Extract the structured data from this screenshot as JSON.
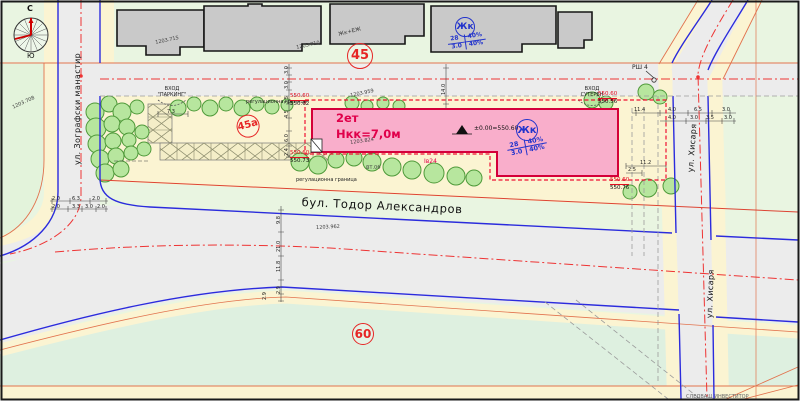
{
  "compass": {
    "north": "С",
    "south": "Ю"
  },
  "streets": {
    "left": "ул. Зографски манастир",
    "boulevard": "бул. Тодор Александров",
    "right": "ул. Хисаря"
  },
  "building": {
    "floors": "2ет",
    "height": "Нкк=7,0м",
    "datum": "±0.00=550.60",
    "plot_code": "Iв24"
  },
  "zone_symbols": [
    {
      "code": "Жк",
      "tl": "28",
      "tr": "40%",
      "bl": "3.0",
      "br": "40%"
    },
    {
      "code": "Жк",
      "tl": "28",
      "tr": "40%",
      "bl": "3.0",
      "br": "40%"
    }
  ],
  "annotations": {
    "entrance_parking_line1": "ВХОД",
    "entrance_parking_line2": "\"ПАРКИНГ\"",
    "entrance_basement_line1": "ВХОД",
    "entrance_basement_line2": "СУТЕРЕН",
    "reg_boundary": "регулационна граница",
    "manhole": "РШ 4",
    "building_top": "Жк+ЕЖ",
    "utility": "ВТ.06",
    "footer": "СЛЕДВАЩ ИНВЕСТИТОР"
  },
  "plot_circles": [
    {
      "label": "45",
      "x": 347,
      "y": 43,
      "d": 26,
      "fs": 13,
      "r": 0
    },
    {
      "label": "45а",
      "x": 234,
      "y": 118,
      "d": 23,
      "fs": 10,
      "r": -15
    },
    {
      "label": "60",
      "x": 352,
      "y": 323,
      "d": 22,
      "fs": 12,
      "r": 0
    }
  ],
  "elevations": [
    {
      "top": "550.60",
      "bottom": "550.62",
      "x": 290,
      "y": 93
    },
    {
      "top": "550.60",
      "bottom": "550.73",
      "x": 290,
      "y": 150
    },
    {
      "top": "550.60",
      "bottom": "550.76",
      "x": 610,
      "y": 177
    },
    {
      "top": "550.60",
      "bottom": "550.56",
      "x": 598,
      "y": 91
    }
  ],
  "survey_points": [
    {
      "t": "1203.708",
      "x": 12,
      "y": 106,
      "r": -25
    },
    {
      "t": "1203.715",
      "x": 155,
      "y": 41,
      "r": -12
    },
    {
      "t": "1203.710",
      "x": 296,
      "y": 46,
      "r": -12
    },
    {
      "t": "1203.959",
      "x": 350,
      "y": 94,
      "r": -12
    },
    {
      "t": "1203.824",
      "x": 350,
      "y": 141,
      "r": -8
    },
    {
      "t": "1203.962",
      "x": 316,
      "y": 226,
      "r": -3
    }
  ],
  "dimensions": [
    {
      "t": "3.0",
      "x": 285,
      "y": 74,
      "r": -90
    },
    {
      "t": "3.0",
      "x": 285,
      "y": 89,
      "r": -90
    },
    {
      "t": "3.5",
      "x": 285,
      "y": 104,
      "r": -90
    },
    {
      "t": "4.5",
      "x": 285,
      "y": 118,
      "r": -90
    },
    {
      "t": "6.0",
      "x": 285,
      "y": 142,
      "r": -90
    },
    {
      "t": "2.4",
      "x": 285,
      "y": 156,
      "r": -90
    },
    {
      "t": "9.8",
      "x": 277,
      "y": 224,
      "r": -90
    },
    {
      "t": "21.0",
      "x": 277,
      "y": 252,
      "r": -90
    },
    {
      "t": "11.8",
      "x": 277,
      "y": 272,
      "r": -90
    },
    {
      "t": "2.9",
      "x": 277,
      "y": 294,
      "r": -90
    },
    {
      "t": "2.9",
      "x": 263,
      "y": 300,
      "r": -90
    },
    {
      "t": "14.0",
      "x": 442,
      "y": 95,
      "r": -90
    },
    {
      "t": "7.3",
      "x": 167,
      "y": 110,
      "r": 0
    },
    {
      "t": "11.4",
      "x": 634,
      "y": 108,
      "r": 0
    },
    {
      "t": "4.0",
      "x": 668,
      "y": 108,
      "r": 0
    },
    {
      "t": "6.5",
      "x": 694,
      "y": 108,
      "r": 0
    },
    {
      "t": "3.0",
      "x": 722,
      "y": 108,
      "r": 0
    },
    {
      "t": "4.0",
      "x": 668,
      "y": 116,
      "r": 0
    },
    {
      "t": "3.0",
      "x": 690,
      "y": 116,
      "r": 0
    },
    {
      "t": "3.5",
      "x": 706,
      "y": 116,
      "r": 0
    },
    {
      "t": "3.0",
      "x": 724,
      "y": 116,
      "r": 0
    },
    {
      "t": "11.2",
      "x": 640,
      "y": 161,
      "r": 0
    },
    {
      "t": "2.5",
      "x": 628,
      "y": 168,
      "r": 0
    },
    {
      "t": "2.0",
      "x": 52,
      "y": 197,
      "r": 0
    },
    {
      "t": "6.3",
      "x": 72,
      "y": 197,
      "r": 0
    },
    {
      "t": "2.0",
      "x": 92,
      "y": 197,
      "r": 0
    },
    {
      "t": "2.0",
      "x": 52,
      "y": 205,
      "r": 0
    },
    {
      "t": "3.3",
      "x": 72,
      "y": 205,
      "r": 0
    },
    {
      "t": "3.0",
      "x": 85,
      "y": 205,
      "r": 0
    },
    {
      "t": "2.0",
      "x": 97,
      "y": 205,
      "r": 0
    }
  ],
  "colors": {
    "plot_fill": "#f9aecb",
    "plot_border": "#d4003a",
    "boundary_red": "#ee1133",
    "curb_blue": "#2b2bdd",
    "centerline_red": "#ee3333",
    "zone_blue": "#2233cc"
  }
}
